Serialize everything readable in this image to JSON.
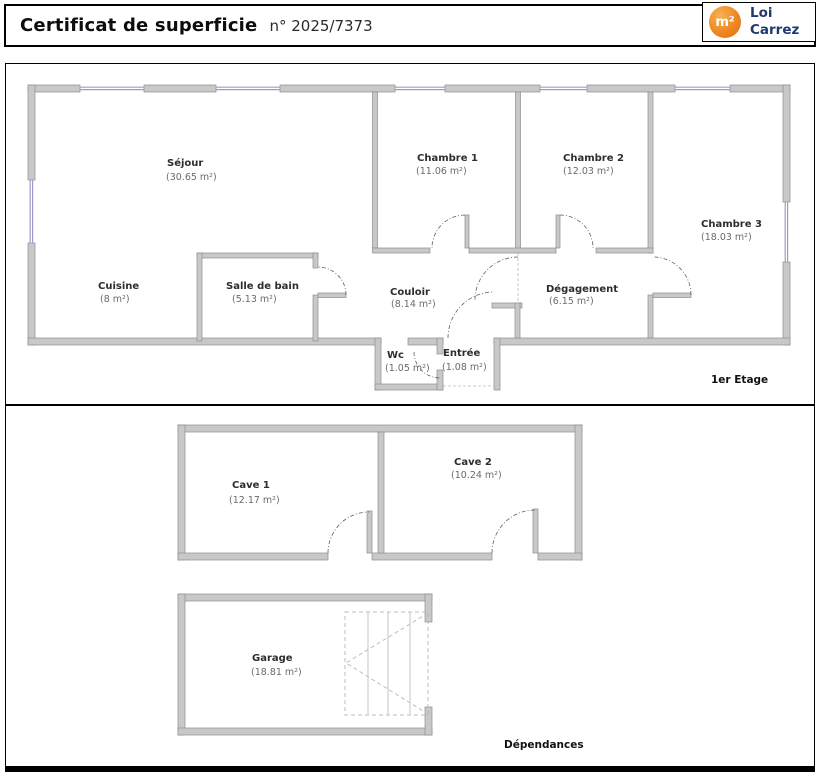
{
  "header": {
    "title": "Certificat de superficie",
    "doc_number": "n° 2025/7373",
    "logo": {
      "symbol": "m²",
      "line1": "Loi",
      "line2": "Carrez"
    }
  },
  "floor1": {
    "caption": "1er Etage",
    "rooms": {
      "sejour": {
        "name": "Séjour",
        "area": "(30.65 m²)"
      },
      "chambre1": {
        "name": "Chambre 1",
        "area": "(11.06 m²)"
      },
      "chambre2": {
        "name": "Chambre 2",
        "area": "(12.03 m²)"
      },
      "chambre3": {
        "name": "Chambre 3",
        "area": "(18.03 m²)"
      },
      "cuisine": {
        "name": "Cuisine",
        "area": "(8 m²)"
      },
      "salle_de_bain": {
        "name": "Salle de bain",
        "area": "(5.13 m²)"
      },
      "couloir": {
        "name": "Couloir",
        "area": "(8.14 m²)"
      },
      "degagement": {
        "name": "Dégagement",
        "area": "(6.15 m²)"
      },
      "wc": {
        "name": "Wc",
        "area": "(1.05 m²)"
      },
      "entree": {
        "name": "Entrée",
        "area": "(1.08 m²)"
      }
    }
  },
  "floor2": {
    "caption": "Dépendances",
    "rooms": {
      "cave1": {
        "name": "Cave 1",
        "area": "(12.17 m²)"
      },
      "cave2": {
        "name": "Cave 2",
        "area": "(10.24 m²)"
      },
      "garage": {
        "name": "Garage",
        "area": "(18.81 m²)"
      }
    }
  },
  "colors": {
    "wall_fill": "#c8c8c8",
    "wall_stroke": "#8e8e8e",
    "window_blue": "#9c9cca",
    "logo_orange": "#ee8722",
    "brand_blue": "#1e3a6e"
  }
}
